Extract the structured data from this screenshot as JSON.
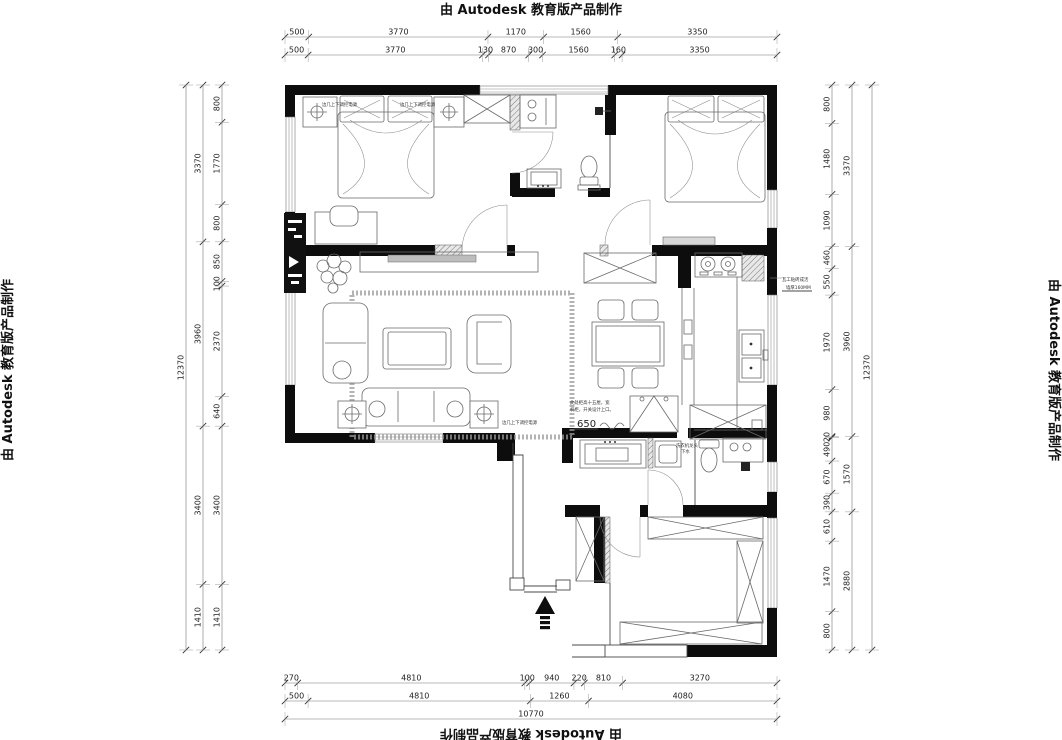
{
  "watermark": {
    "text": "由 Autodesk 教育版产品制作"
  },
  "dimensions": {
    "top": {
      "row1": [
        "500",
        "3770",
        "1170",
        "1560",
        "3350"
      ],
      "row2": [
        "500",
        "3770",
        "130",
        "870",
        "300",
        "1560",
        "160",
        "3350"
      ]
    },
    "bottom": {
      "row1": [
        "270",
        "4810",
        "100",
        "940",
        "220",
        "810",
        "3270"
      ],
      "row2": [
        "500",
        "4810",
        "1260",
        "4080"
      ],
      "row3": [
        "10770"
      ]
    },
    "left": {
      "inner": [
        "800",
        "1770",
        "800",
        "850",
        "100",
        "2370",
        "640",
        "3400",
        "1410"
      ],
      "middle": [
        "3370",
        "3960",
        "3400",
        "1410"
      ],
      "outer": [
        "12370"
      ]
    },
    "right": {
      "inner": [
        "800",
        "1480",
        "1090",
        "460",
        "550",
        "1970",
        "980",
        "20",
        "490",
        "670",
        "390",
        "610",
        "1470",
        "800"
      ],
      "middle": [
        "3370",
        "3960",
        "1570",
        "2880"
      ],
      "outer": [
        "12370"
      ]
    }
  },
  "annotations": {
    "nightstand_left": "边几上下调控电源",
    "nightstand_right": "边几上下调控电源",
    "side_table": "边几上下调控电源",
    "tile_note_1": "瓦工贴砖成活",
    "tile_note_2": "墙厚160MM",
    "cabinet_note_1": "此处柜高十五厘，宽",
    "cabinet_note_2": "机柜，开关设计上口。",
    "cabinet_dim": "650",
    "washer_note_1": "洗衣机龙头",
    "washer_note_2": "下水",
    "logo_text": "拓者设计"
  }
}
